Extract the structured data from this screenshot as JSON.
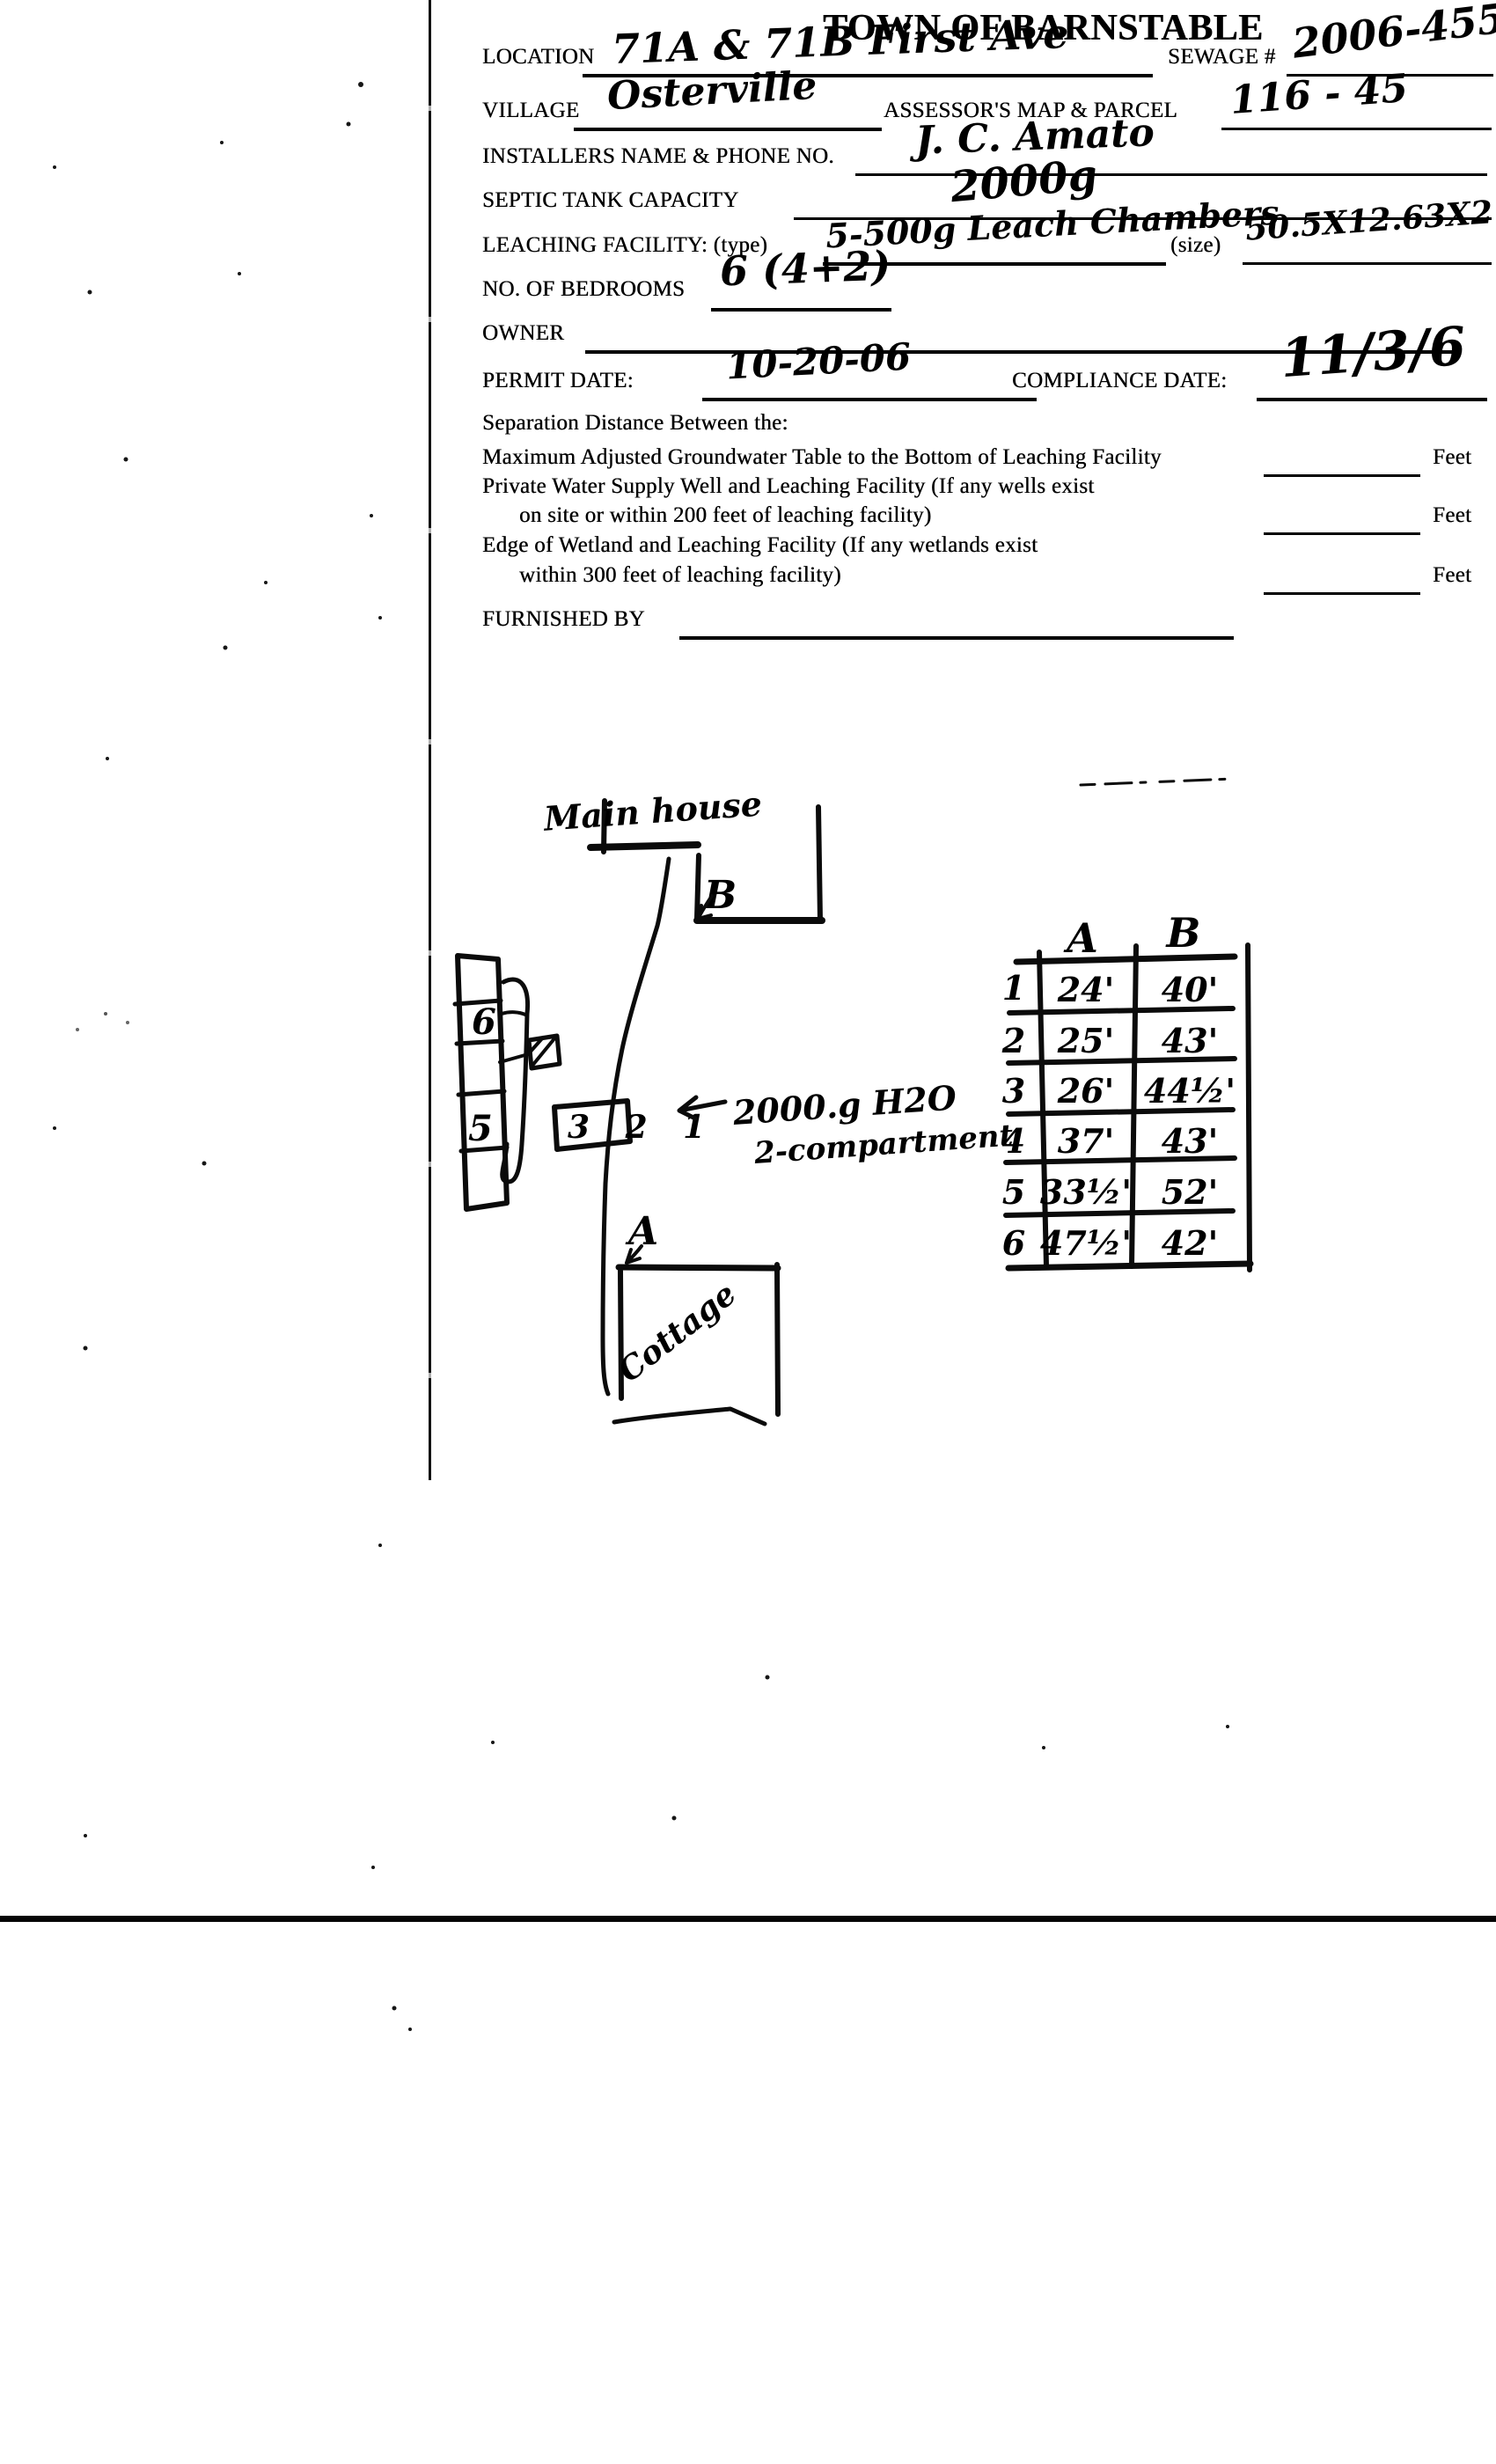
{
  "form": {
    "title": "TOWN OF BARNSTABLE",
    "location_label": "LOCATION",
    "location_value": "71A & 71B First Ave",
    "sewage_label": "SEWAGE #",
    "sewage_value": "2006-455",
    "village_label": "VILLAGE",
    "village_value": "Osterville",
    "map_parcel_label": "ASSESSOR'S MAP & PARCEL",
    "map_parcel_value": "116 - 45",
    "installer_label": "INSTALLERS NAME & PHONE NO.",
    "installer_value": "J. C. Amato",
    "septic_label": "SEPTIC TANK CAPACITY",
    "septic_value": "2000g",
    "leaching_label": "LEACHING FACILITY: (type)",
    "leaching_type_value": "5-500g Leach Chambers",
    "size_label": "(size)",
    "size_value": "50.5X12.63X2",
    "bedrooms_label": "NO. OF BEDROOMS",
    "bedrooms_value": "6 (4+2)",
    "owner_label": "OWNER",
    "permit_label": "PERMIT DATE:",
    "permit_value": "10-20-06",
    "compliance_label": "COMPLIANCE DATE:",
    "compliance_value": "11/3/6",
    "separation_heading": "Separation Distance Between the:",
    "sep1_text": "Maximum Adjusted Groundwater Table to the Bottom of Leaching Facility",
    "sep2_text1": "Private Water Supply Well and Leaching Facility (If any wells exist",
    "sep2_text2": "on site or within 200 feet of leaching facility)",
    "sep3_text1": "Edge of Wetland and Leaching Facility (If any wetlands exist",
    "sep3_text2": "within 300 feet of leaching facility)",
    "feet_unit": "Feet",
    "furnished_label": "FURNISHED BY"
  },
  "sketch": {
    "main_house_label": "Main house",
    "cottage_label": "Cottage",
    "point_a": "A",
    "point_b": "B",
    "chamber_top": "6",
    "chamber_bottom": "5",
    "dbox_numbers": "3 2 1",
    "tank_note_line1": "2000.g H2O",
    "tank_note_line2": "2-compartment",
    "table": {
      "col_a": "A",
      "col_b": "B",
      "rows": [
        {
          "n": "1",
          "a": "24'",
          "b": "40'"
        },
        {
          "n": "2",
          "a": "25'",
          "b": "43'"
        },
        {
          "n": "3",
          "a": "26'",
          "b": "44½'"
        },
        {
          "n": "4",
          "a": "37'",
          "b": "43'"
        },
        {
          "n": "5",
          "a": "33½'",
          "b": "52'"
        },
        {
          "n": "6",
          "a": "47½'",
          "b": "42'"
        }
      ]
    }
  }
}
